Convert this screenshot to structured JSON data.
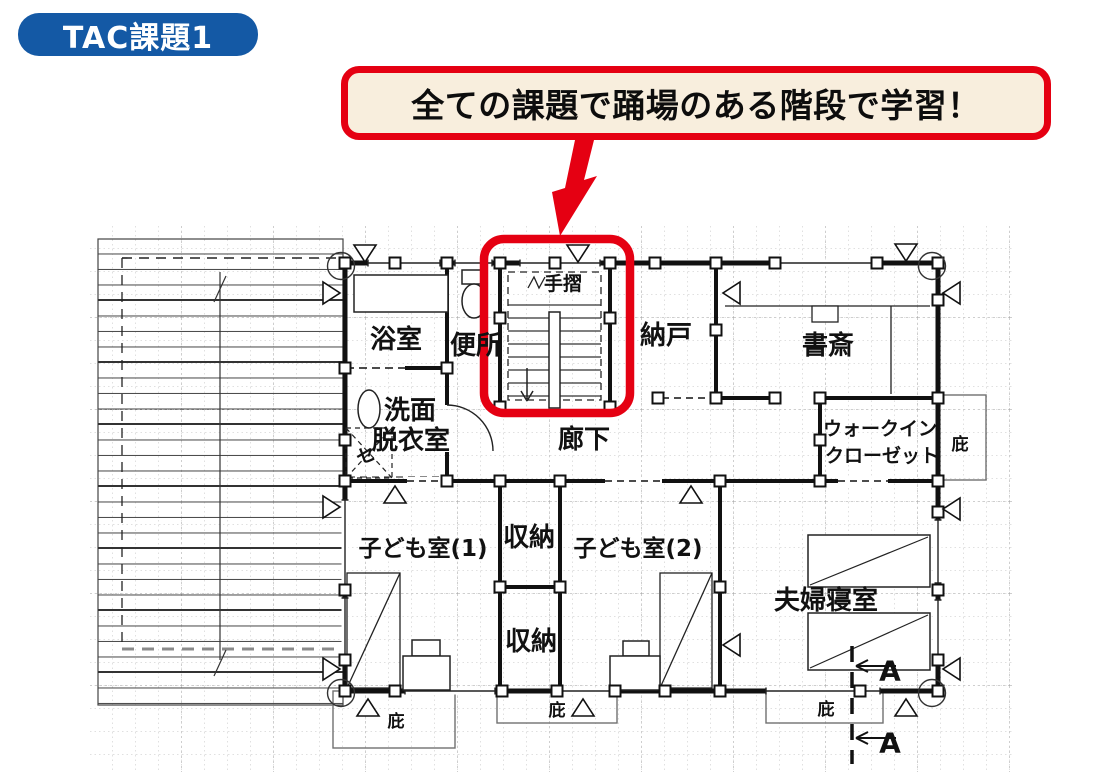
{
  "badge": {
    "label": "TAC課題1",
    "bg_color": "#1459a5",
    "text_color": "#ffffff"
  },
  "callout": {
    "text": "全ての課題で踊場のある階段で学習！",
    "border_color": "#e50012",
    "bg_color": "#f8eedd",
    "text_color": "#0d0d0d"
  },
  "plan": {
    "rooms": {
      "bath": "浴室",
      "toilet": "便所",
      "handrail": "手摺",
      "storeroom": "納戸",
      "study": "書斎",
      "washroom_line1": "洗面",
      "washroom_line2": "脱衣室",
      "washer_mark": "セ",
      "corridor": "廊下",
      "wic_line1": "ウォークイン",
      "wic_line2": "クローゼット",
      "kids_room_1": "子ども室(1)",
      "kids_room_2": "子ども室(2)",
      "closet_upper": "収納",
      "closet_lower": "収納",
      "master_bedroom": "夫婦寝室",
      "eave_right": "庇",
      "eave_bottom_left": "庇",
      "eave_bottom_center": "庇",
      "eave_bottom_right": "庇"
    },
    "section_marks": {
      "top": "A",
      "bottom": "A"
    },
    "highlight_color": "#e50012"
  }
}
